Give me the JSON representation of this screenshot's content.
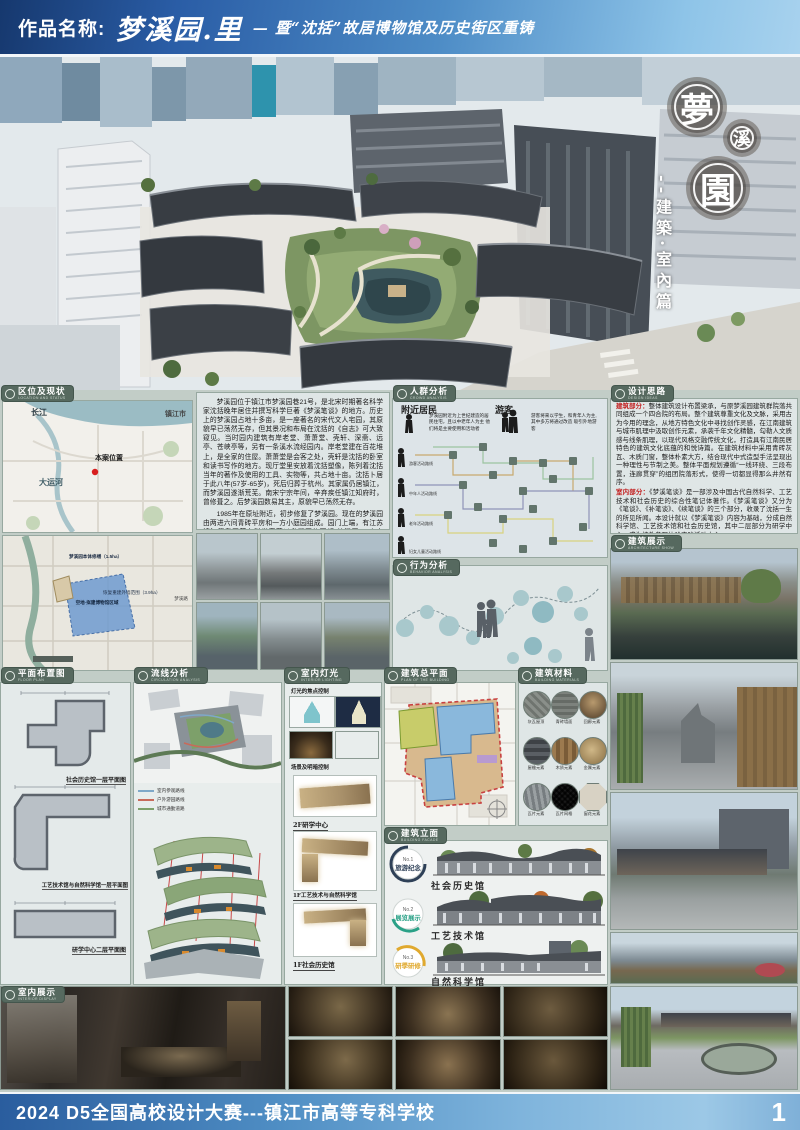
{
  "banner_top": {
    "label": "作品名称:",
    "title": "梦溪园.里",
    "subtitle": "— 暨“沈括”故居博物馆及历史街区重铸"
  },
  "hero": {
    "badge1": "夢",
    "badge2": "溪",
    "badge3": "園",
    "vertical_title": "--建築·室內篇"
  },
  "location": {
    "header": "区位及现状",
    "header_en": "LOCATION AND STATUS",
    "map": {
      "river": "长江",
      "city": "镇江市",
      "site": "本案位置",
      "canal": "大运河"
    },
    "siteplan": {
      "repair": "梦溪园本体修缮（1.5ha）",
      "rebuild": "恢复重建外墙范围（3.9ha）",
      "empty": "空地·拟建博物馆区域",
      "road": "梦溪路"
    },
    "intro_p1": "梦溪园位于镇江市梦溪园巷21号，是北宋时期著名科学家沈括晚年居住并撰写科学巨著《梦溪笔谈》的地方。历史上的梦溪园占地十多亩，是一座著名的宋代文人宅园，其原貌早已荡然无存，但其景况和布局在沈括的《自志》可大致窥见。当时园内建筑有岸老堂、萧萧堂、壳轩、深斋、远亭、苍峡亭等，另有一条溪水流经园内。岸老堂建在百花堆上，是全家的住屋。萧萧堂是会客之处，壳轩是沈括的卧室和读书写作的地方。现厅堂里安放着沈括塑像，陈列着沈括当年的著作及使用的工具、实物等，共占地十亩。沈括卜居于此八年(57岁-65岁)，死后归葬于杭州。其家属仍居镇江，而梦溪园遂渐荒芜。南宋宁宗年间，辛弃疾任镇江知府时，曾修葺之。后梦溪园数易其主，原貌早已荡然无存。",
    "intro_p2": "1985年在原址附近，初步修复了梦溪园。现在的梦溪园由两进六间青砖平房和一方小庭园组成。园门上端，有江苏镇江籍我国著名科学家茅以升题写的石额“梦溪园”三个大字，苍劲有力。"
  },
  "crowd": {
    "header": "人群分析",
    "header_en": "CROWD ANALYSIS",
    "residents_title": "附近居民",
    "residents_text": "梦溪园附近为上世纪建造的居民住宅，且以中老年人为主 他们将是主要使用和活动者",
    "visitors_title": "游客",
    "visitors_text": "游客将来以学生，和青年人为主,其中多方将通过改造 吸引外地游客",
    "routes": [
      "游客活动路线",
      "中年人活动路线",
      "老年活动路线",
      "妇女儿童活动路线"
    ]
  },
  "behavior": {
    "header": "行为分析",
    "header_en": "BEHAVIOR ANALYSIS"
  },
  "design": {
    "header": "设计思路",
    "header_en": "DESIGN IDEAS",
    "arch_label": "建筑部分：",
    "arch_text": "整体建筑设计布置梁承，与原梦溪园建筑群院落共同组成一个四合院的布局。整个建筑尊重文化及文脉，采用古为今用的理念，从地方特色文化中寻找创作灵感，在江南建筑与城市肌理中汲取创作元素，承袭千年文化精髓，勾勒人文质感与线条肌理，以现代风格交融传统文化，打造具有江南民居特色的建筑文化底蕴的和悦诗篇。在建筑材料中采用青砖灰瓦、木质门窗，整体朴素大方，结合现代中式造型手法呈现出一种理性与节制之美。整体平面规划遵循“一线环绕、三段布置，连廊贯穿”的组团院落形式，使得一切都显得那么井然有序。",
    "interior_label": "室内部分：",
    "interior_text": "《梦溪笔谈》是一部涉及中国古代自然科学、工艺技术和社会历史的综合性笔记体著作。《梦溪笔谈》又分为《笔谈》、《补笔谈》、《续笔谈》的三个部分，收录了沈括一生的所见所闻。本设计就以《梦溪笔谈》内容为基础，分成自然科学馆、工艺技术馆和社会历史馆，其中二层部分为研学中心，成为校外参观体验实践活动中心。"
  },
  "arch_show": {
    "header": "建筑展示",
    "header_en": "ARCHITECTURE SHOW"
  },
  "plans": {
    "header": "平面布置图",
    "header_en": "FLOOR PLAN",
    "captions": [
      "社会历史馆一层平面图",
      "工艺技术馆与自然科学馆一层平面图",
      "研学中心二层平面图"
    ]
  },
  "circulation": {
    "header": "流线分析",
    "header_en": "CIRCULATION ANALYSIS",
    "legend": [
      "室内参观路线",
      "户外游园路线",
      "城市通勤道路"
    ]
  },
  "lighting": {
    "header": "室内灯光",
    "header_en": "INTERIOR LIGHTING",
    "item1": "灯光的焦点控制",
    "item2": "场景及明暗控制",
    "plan_labels": [
      "2F研学中心",
      "1F工艺技术与自然科学馆",
      "1F社会历史馆"
    ]
  },
  "siteplan": {
    "header": "建筑总平面",
    "header_en": "PLAN OF THE BUILDING"
  },
  "materials": {
    "header": "建筑材料",
    "header_en": "BUILDING MATERIALS",
    "items": [
      "灰瓦屋顶",
      "青砖墙面",
      "回廊元素",
      "屋檐元素",
      "木质元素",
      "金属元素",
      "瓦片元素",
      "瓦片网格",
      "窗花元素"
    ]
  },
  "facade": {
    "header": "建筑立面",
    "header_en": "BUILDING FACADE",
    "items": [
      {
        "no": "No.1",
        "tag": "旅游纪念",
        "name": "社会历史馆",
        "color": "#2e4057"
      },
      {
        "no": "No.2",
        "tag": "展览展示",
        "name": "工艺技术馆",
        "color": "#2aa187"
      },
      {
        "no": "No.3",
        "tag": "研學研修",
        "name": "自然科学馆",
        "color": "#e0a92e"
      }
    ]
  },
  "interior_show": {
    "header": "室内展示",
    "header_en": "INTERIOR DISPLAY"
  },
  "banner_bottom": {
    "text": "2024 D5全国高校设计大赛---镇江市高等专科学校",
    "page": "1"
  },
  "colors": {
    "accent_teal": "#56695f",
    "banner_blue": "#2a5da6",
    "route_indoor": "#7fa8c8",
    "route_garden": "#c86a5a",
    "route_city": "#7da06a"
  }
}
